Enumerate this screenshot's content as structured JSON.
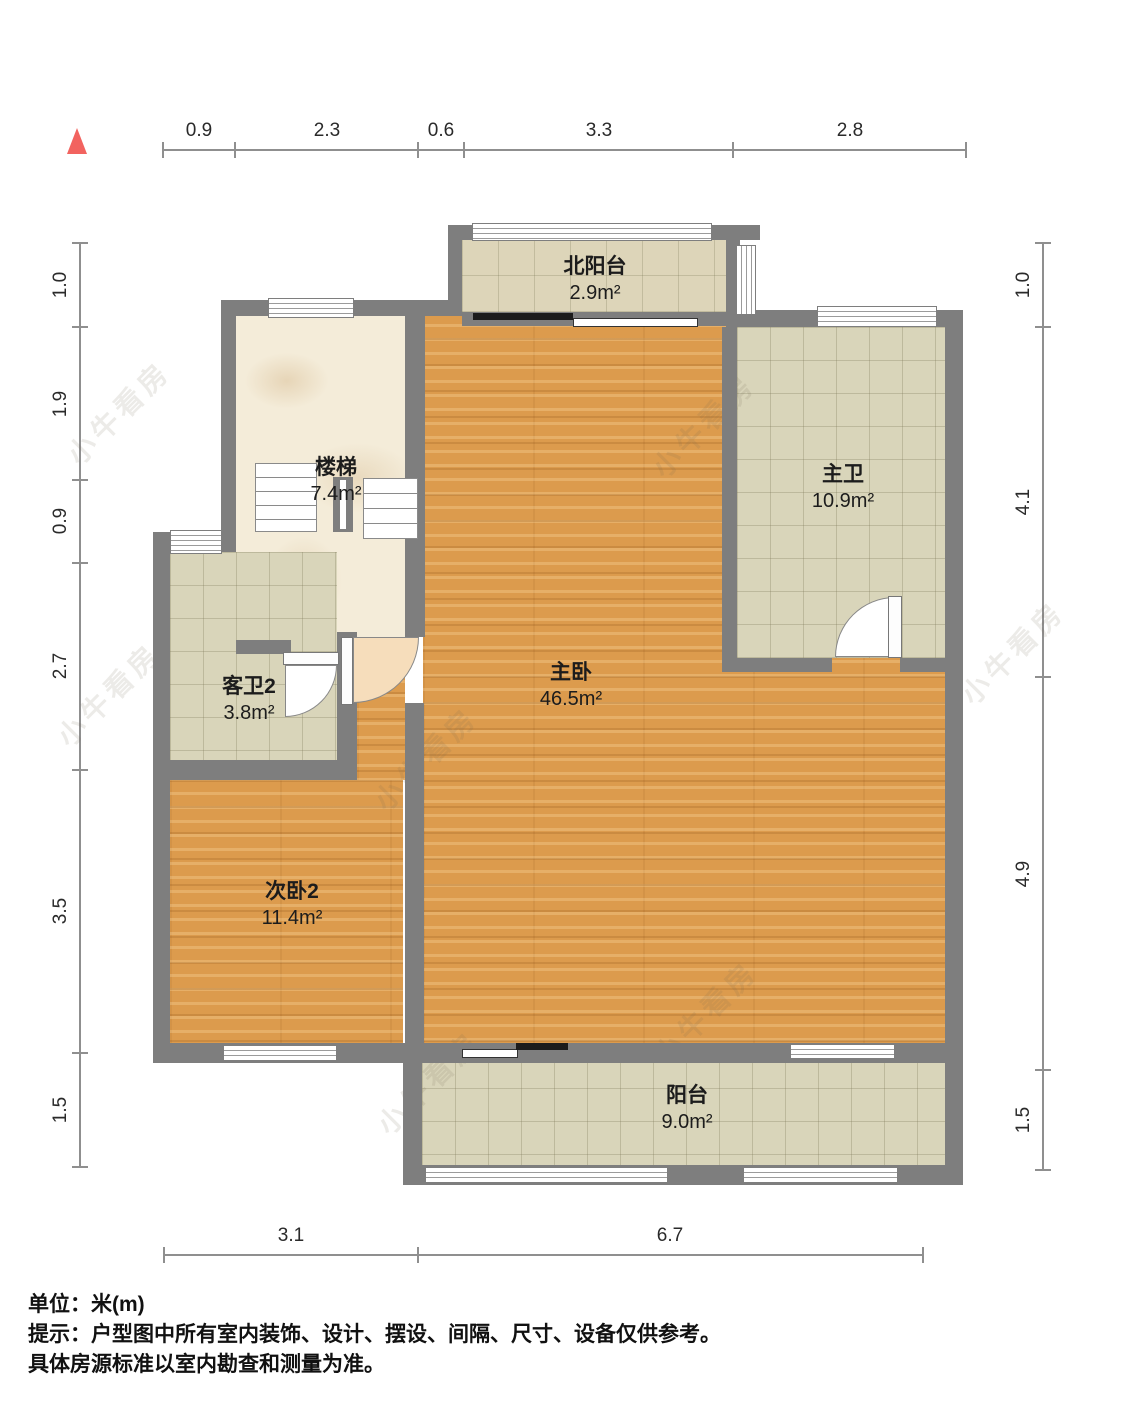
{
  "watermark": "小牛看房",
  "dims": {
    "top": [
      "0.9",
      "2.3",
      "0.6",
      "3.3",
      "2.8"
    ],
    "left": [
      "1.0",
      "1.9",
      "0.9",
      "2.7",
      "3.5",
      "1.5"
    ],
    "right": [
      "1.0",
      "4.1",
      "4.9",
      "1.5"
    ],
    "bottom": [
      "3.1",
      "6.7"
    ]
  },
  "rooms": {
    "north_balcony": {
      "name": "北阳台",
      "area": "2.9m²"
    },
    "stairs": {
      "name": "楼梯",
      "area": "7.4m²"
    },
    "master_bath": {
      "name": "主卫",
      "area": "10.9m²"
    },
    "guest_bath": {
      "name": "客卫2",
      "area": "3.8m²"
    },
    "master_bedroom": {
      "name": "主卧",
      "area": "46.5m²"
    },
    "second_bedroom": {
      "name": "次卧2",
      "area": "11.4m²"
    },
    "balcony": {
      "name": "阳台",
      "area": "9.0m²"
    }
  },
  "footer": {
    "line1": "单位：米(m)",
    "line2": "提示：户型图中所有室内装饰、设计、摆设、间隔、尺寸、设备仅供参考。",
    "line3": "具体房源标准以室内勘查和测量为准。"
  },
  "colors": {
    "wall": "#7e7e7e",
    "wood_floor": "#dc9b4d",
    "tile_floor": "#d9d5ba",
    "marble_floor": "#f4ecd9",
    "door_swing_peach": "#f6ddbb",
    "north_arrow": "#f2635f"
  }
}
